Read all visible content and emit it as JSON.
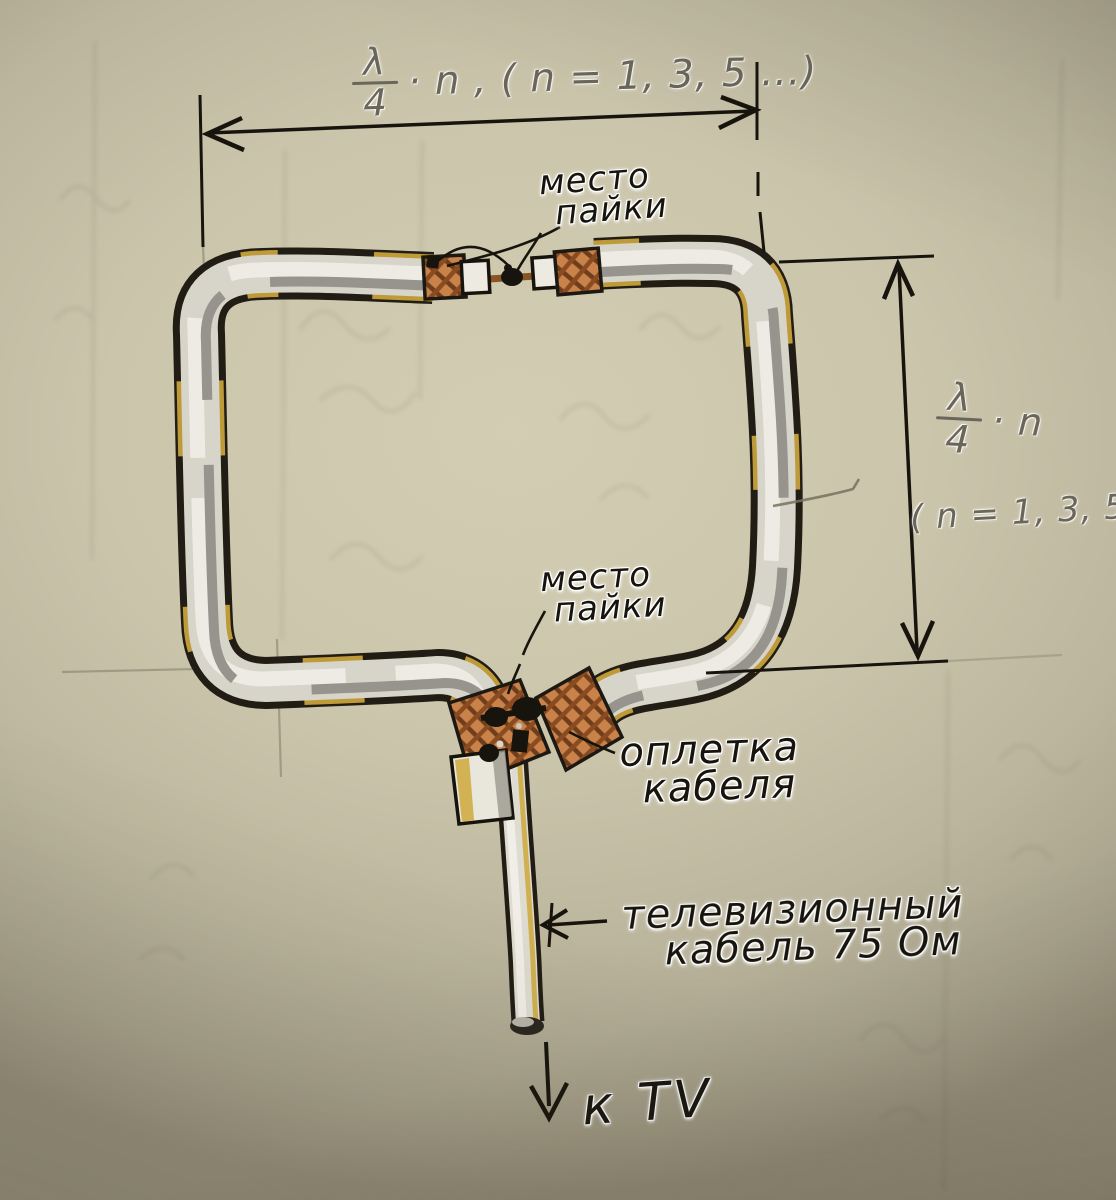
{
  "document": {
    "kind": "hand-drawn sketch of a loop (frame) TV antenna made from coaxial cable",
    "language": "Russian"
  },
  "labels": {
    "top_dimension": {
      "numerator": "λ",
      "denominator": "4",
      "suffix": "· n , ( n = 1, 3, 5 ...)"
    },
    "right_dimension": {
      "numerator": "λ",
      "denominator": "4",
      "suffix": "· n",
      "constraint": "( n = 1, 3, 5 ...)"
    },
    "solder_joint_top": {
      "line1": "место",
      "line2": "пайки"
    },
    "solder_joint_bottom": {
      "line1": "место",
      "line2": "пайки"
    },
    "cable_braid": {
      "line1": "оплетка",
      "line2": "кабеля"
    },
    "feed_cable": {
      "line1": "телевизионный",
      "line2": "кабель 75 Ом"
    },
    "to_tv": "к TV"
  },
  "colors": {
    "paper": "#c7c1a9",
    "ink": "#17140d",
    "pencil": "#6f6b60",
    "cable_body": "#d7d4c9",
    "cable_highlight": "#edebe4",
    "cable_shadow": "#97948e",
    "tape_yellow": "#cfa83c",
    "braid_copper": "#c9834a",
    "braid_shadow": "#6e3d1c",
    "solder_black": "#17140e",
    "insulation_white": "#eceae1"
  }
}
